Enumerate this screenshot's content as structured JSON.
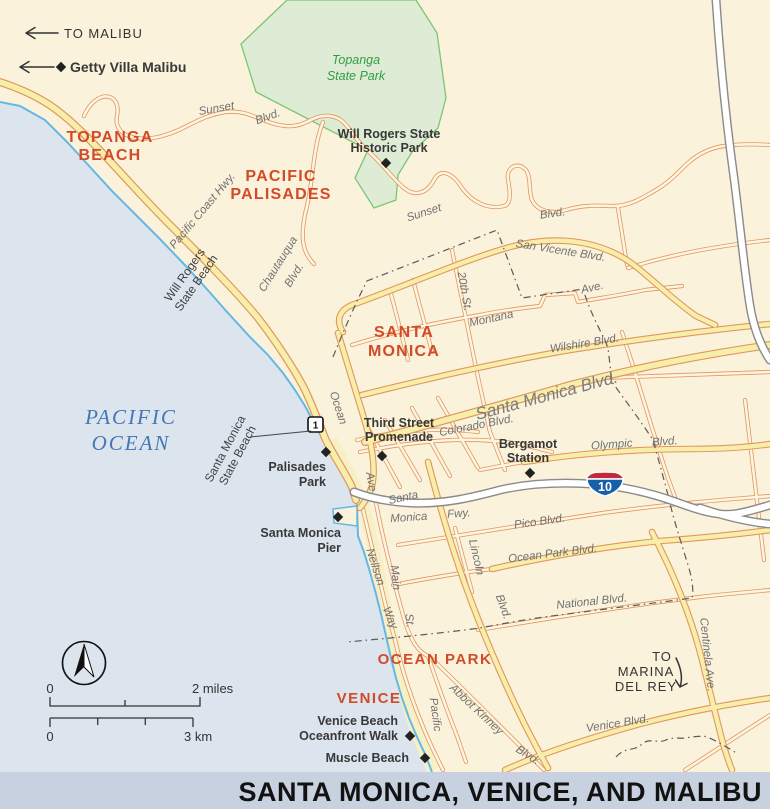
{
  "title": "SANTA MONICA, VENICE, AND MALIBU",
  "directions": {
    "to_malibu": "TO MALIBU",
    "getty_villa": "Getty Villa Malibu",
    "marina_l1": "TO",
    "marina_l2": "MARINA",
    "marina_l3": "DEL REY"
  },
  "regions": {
    "topanga_beach_l1": "TOPANGA",
    "topanga_beach_l2": "BEACH",
    "pacific_palisades_l1": "PACIFIC",
    "pacific_palisades_l2": "PALISADES",
    "santa_monica_l1": "SANTA",
    "santa_monica_l2": "MONICA",
    "ocean_park": "OCEAN PARK",
    "venice": "VENICE"
  },
  "water": {
    "l1": "PACIFIC",
    "l2": "OCEAN"
  },
  "parks": {
    "topanga_l1": "Topanga",
    "topanga_l2": "State Park"
  },
  "beaches": {
    "will_rogers_l1": "Will Rogers",
    "will_rogers_l2": "State Beach",
    "santa_monica_l1": "Santa Monica",
    "santa_monica_l2": "State Beach"
  },
  "pois": {
    "will_rogers_park_l1": "Will Rogers State",
    "will_rogers_park_l2": "Historic Park",
    "third_street_l1": "Third Street",
    "third_street_l2": "Promenade",
    "bergamot_l1": "Bergamot",
    "bergamot_l2": "Station",
    "palisades_park_l1": "Palisades",
    "palisades_park_l2": "Park",
    "sm_pier_l1": "Santa Monica",
    "sm_pier_l2": "Pier",
    "venice_walk_l1": "Venice Beach",
    "venice_walk_l2": "Oceanfront Walk",
    "muscle_beach": "Muscle Beach"
  },
  "roads": {
    "sunset1_l1": "Sunset",
    "sunset1_l2": "Blvd.",
    "sunset2_l1": "Sunset",
    "sunset2_l2": "Blvd.",
    "pch": "Pacific  Coast  Hwy.",
    "chautauqua_l1": "Chautauqua",
    "chautauqua_l2": "Blvd.",
    "san_vicente": "San Vicente Blvd.",
    "montana_l1": "Montana",
    "montana_l2": "Ave.",
    "twentieth": "20th St.",
    "wilshire": "Wilshire Blvd.",
    "santa_monica_blvd": "Santa Monica Blvd.",
    "colorado": "Colorado Blvd.",
    "olympic_l1": "Olympic",
    "olympic_l2": "Blvd.",
    "ocean_l1": "Ocean",
    "ocean_l2": "Ave.",
    "smfwy_l1": "Santa",
    "smfwy_l2": "Monica",
    "smfwy_l3": "Fwy.",
    "pico": "Pico Blvd.",
    "ocean_park": "Ocean Park Blvd.",
    "national": "National Blvd.",
    "neilson_l1": "Neilson",
    "neilson_l2": "Way",
    "main_l1": "Main",
    "main_l2": "St.",
    "lincoln_l1": "Lincoln",
    "lincoln_l2": "Blvd.",
    "pacific_ave": "Pacific",
    "abbot_l1": "Abbot Kinney",
    "abbot_l2": "Blvd.",
    "venice_blvd": "Venice Blvd.",
    "centinela": "Centinela Ave."
  },
  "shields": {
    "i10": "10",
    "ca1": "1"
  },
  "scalebar": {
    "mi_0": "0",
    "mi_label": "2 miles",
    "km_0": "0",
    "km_label": "3 km"
  },
  "colors": {
    "ocean": "#dce4ee",
    "land": "#fbf2dc",
    "park_fill": "#deecd5",
    "park_edge": "#7cc576",
    "road_casing": "#e0975c",
    "road_major_fill": "#f8eeac",
    "freeway_fill": "#ffffff",
    "coastline": "#63b8e4",
    "region_label": "#d14b28",
    "park_label": "#2f9e44",
    "ocean_label": "#4377b5",
    "title_bar_bg": "#c8d1e0",
    "interstate_blue": "#1560a8",
    "interstate_red": "#c2293a"
  }
}
